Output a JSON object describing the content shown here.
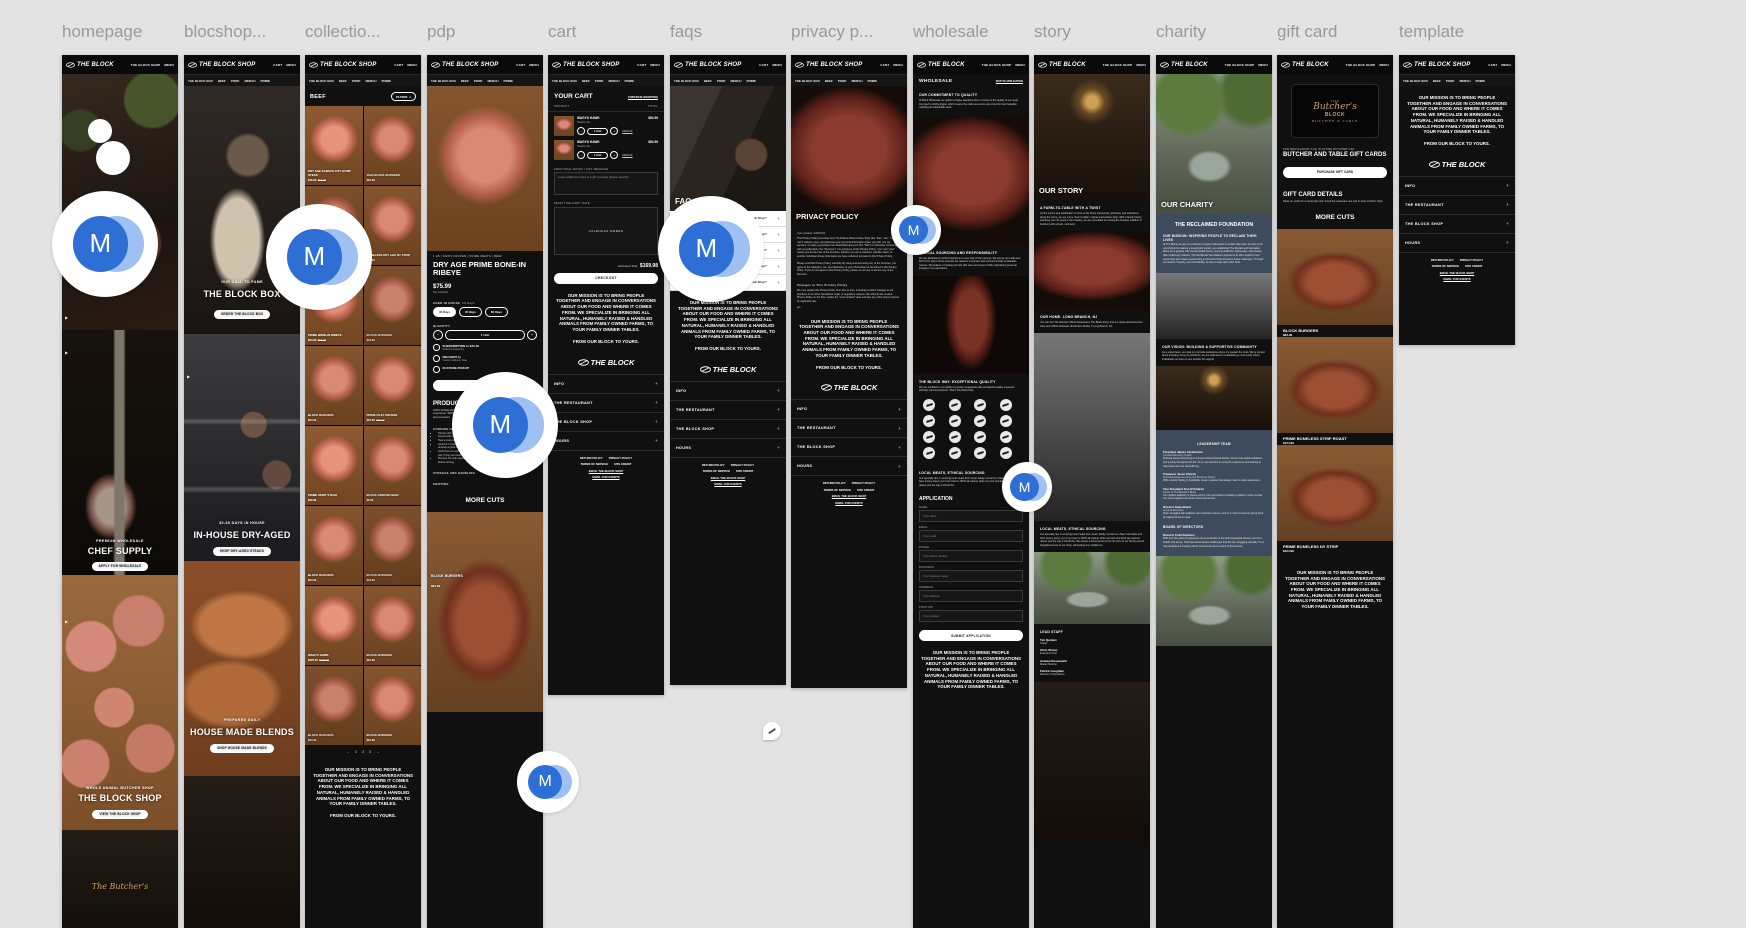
{
  "labels": [
    {
      "text": "homepage",
      "left": "62px"
    },
    {
      "text": "blocshop...",
      "left": "184px"
    },
    {
      "text": "collectio...",
      "left": "305px"
    },
    {
      "text": "pdp",
      "left": "427px"
    },
    {
      "text": "cart",
      "left": "548px"
    },
    {
      "text": "faqs",
      "left": "670px"
    },
    {
      "text": "privacy p...",
      "left": "791px"
    },
    {
      "text": "wholesale",
      "left": "913px"
    },
    {
      "text": "story",
      "left": "1034px"
    },
    {
      "text": "charity",
      "left": "1156px"
    },
    {
      "text": "gift card",
      "left": "1277px"
    },
    {
      "text": "template",
      "left": "1399px"
    }
  ],
  "chrome": {
    "logo_block": "THE BLOCK",
    "logo_shop": "THE BLOCK SHOP",
    "right_shop": [
      "CART",
      "MENU"
    ],
    "right_block": [
      "THE BLOCK SHOP",
      "MENU"
    ],
    "nav": [
      "THE BLOCK BOX",
      "BEEF",
      "PORK",
      "MERCH",
      "PRIME"
    ],
    "play": "▶"
  },
  "mission": {
    "text": "OUR MISSION IS TO BRING PEOPLE TOGETHER AND ENGAGE IN CONVERSATIONS ABOUT OUR FOOD AND WHERE IT COMES FROM. WE SPECIALIZE IN BRINGING ALL NATURAL, HUMANELY RAISED & HANDLED ANIMALS FROM FAMILY OWNED FARMS, TO YOUR FAMILY DINNER TABLES.",
    "tagline": "FROM OUR BLOCK TO YOURS."
  },
  "footer": {
    "accordion": [
      "INFO",
      "THE RESTAURANT",
      "THE BLOCK SHOP",
      "HOURS"
    ],
    "plus": "+",
    "links_row1": [
      "RETURN POLICY",
      "PRIVACY POLICY"
    ],
    "links_row2": [
      "TERMS OF SERVICE",
      "SITE CREDIT"
    ],
    "email1": "EMAIL THE BLOCK SHOP",
    "email2": "EMAIL FOR EVENTS"
  },
  "homepage": {
    "sign": "OCK",
    "neon": "The Butcher's",
    "hero2": {
      "k": "PREMIUM WHOLESALE",
      "t": "CHEF SUPPLY",
      "b": "APPLY FOR WHOLESALE"
    },
    "hero3": {
      "k": "WHOLE ANIMAL BUTCHER SHOP",
      "t": "THE BLOCK SHOP",
      "b": "VIEW THE BLOCK SHOP"
    }
  },
  "blockshop": {
    "hero1": {
      "k": "OUR CALL TO FAME",
      "t": "THE BLOCK BOX",
      "b": "ORDER THE BLOCK BOX"
    },
    "hero2": {
      "k": "30-60 DAYS IN HOUSE",
      "t": "IN-HOUSE DRY-AGED",
      "b": "SHOP DRY-AGED STEAKS"
    },
    "hero3": {
      "k": "PREPARED DAILY",
      "t": "HOUSE MADE BLENDS",
      "b": "SHOP HOUSE MADE BLENDS"
    }
  },
  "collection": {
    "title": "BEEF",
    "filters": "FILTERS",
    "filters_icon": "≡",
    "products": [
      {
        "n": "DRY AGE KANSAS CITY STRIP STEAK",
        "p": "$46.99",
        "o": "$64.99"
      },
      {
        "n": "10LB BLOCK BURGERS",
        "p": "$84.99"
      },
      {
        "n": "BLOCK BURGERS",
        "p": "$64.99"
      },
      {
        "n": "BONELESS DRY AGE NY STRIP",
        "p": "$52.99"
      },
      {
        "n": "PRIME BONE-IN RIBEYE",
        "p": "$24.99",
        "o": "$69.99"
      },
      {
        "n": "BLOCK BURGERS",
        "p": "$64.99"
      },
      {
        "n": "BLOCK BURGERS",
        "p": "$64.99"
      },
      {
        "n": "PRIME FILET MIGNON",
        "p": "$52.99",
        "o": "$64.99"
      },
      {
        "n": "PRIME SKIRT STEAK",
        "p": "$29.99"
      },
      {
        "n": "BLOCK GROUND BEEF",
        "p": "$6.99"
      },
      {
        "n": "BLOCK BURGERS",
        "p": "$64.99"
      },
      {
        "n": "BLOCK BURGERS",
        "p": "$64.99"
      },
      {
        "n": "WAGYU HAWK",
        "p": "$225.00",
        "o": "$275.00"
      },
      {
        "n": "BLOCK BURGERS",
        "p": "$64.99"
      },
      {
        "n": "BLOCK BURGERS",
        "p": "$64.99"
      },
      {
        "n": "BLOCK BURGERS",
        "p": "$64.99"
      }
    ],
    "pagination": [
      "←",
      "1",
      "2",
      "3",
      "→"
    ]
  },
  "pdp": {
    "meta": "1 LB  |  SHIPS FROZEN  |  PRIME MEATS  |  BEEF",
    "title": "DRY AGE PRIME BONE-IN RIBEYE",
    "price": "$75.99",
    "tax": "Tax included.",
    "aged_label": "AGED IN HOUSE",
    "aged_value": "30 Days",
    "pills": [
      "30 Days",
      "45 Days",
      "60 Days"
    ],
    "qty_label": "QUANTITY",
    "qty": "1 Unit",
    "minus": "−",
    "plus": "+",
    "options": [
      {
        "t": "SUBSCRIPTION to $72.19",
        "s": "Delivery frequency"
      },
      {
        "t": "DELIVERY to",
        "s": "Custom delivery date"
      },
      {
        "t": "IN-STORE PICKUP",
        "s": ""
      }
    ],
    "add_label": "",
    "details_h": "PRODUCT DETAILS",
    "details": "100% All Natural Prime Beef. Aged in house for either 30, 45, or 60 days for a savory experience. While the ribeye is relatively lean, the meat surrounding the bone is fatty and succulent.",
    "cooking_h": "COOKING INSTRUCTIONS",
    "bullets": [
      "Pat the strip steaks dry with paper towels",
      "Generously season both sides of the steaks.",
      "Heat a cast-iron skillet over high heat for 5 to 6 minutes.",
      "Cook for 2 minutes on each side, pressing the strip steaks down gently to help them develop a good sear.",
      "Cook them on each side again for 1 minute. If they are at 110°F, remove them from the pan. If they are below that temperature, continue cooking them for 1 minute on each.",
      "Remove the strip steaks from the pan and set them aside to rest for 5 to 10 minutes before serving."
    ],
    "storage_h": "STORAGE AND HANDLING",
    "shipping_h": "SHIPPING",
    "more_cuts": "MORE CUTS",
    "more_product": {
      "n": "BLOCK BURGERS",
      "p": "$84.99"
    }
  },
  "cart": {
    "title": "YOUR CART",
    "continue": "CONTINUE SHOPPING",
    "col_product": "PRODUCT",
    "col_total": "TOTAL",
    "items": [
      {
        "n": "WAGYU HAWK",
        "price": "$84.99",
        "variant": "Variant info",
        "qty": "1 Unit",
        "remove": "REMOVE"
      },
      {
        "n": "WAGYU HAWK",
        "price": "$84.99",
        "variant": "Variant info",
        "qty": "1 Unit",
        "remove": "REMOVE"
      }
    ],
    "notes_label": "ADDITIONAL NOTES / GIFT MESSAGE",
    "notes_placeholder": "Leave additional notes or a gift message (please specify)",
    "date_label": "SELECT DELIVERY DATE",
    "calendar": "CALENDAR EMBED",
    "total_label": "Estimated Total:",
    "total": "$169.98",
    "checkout": "CHECKOUT"
  },
  "faqs": {
    "title": "FAQs",
    "rows": [
      {
        "q": "What is a common question you are asked about the Block Shop?"
      },
      {
        "q": "What is a common question you are asked about the Block Shop?"
      },
      {
        "q": "What is a common question you are asked about the Block Shop?"
      },
      {
        "q": "What is a common question you are asked about the Block Shop?"
      },
      {
        "q": "What is a common question you are asked about the Block Shop?"
      }
    ],
    "plus": "+"
  },
  "privacy": {
    "title": "PRIVACY POLICY",
    "updated": "Last updated: 9/28/2023",
    "p1": "This Privacy Policy describes how The Butcher Block Online Shop (the \"Site\", \"we\", \"us\", or \"our\") collects, uses, and discloses your personal information when you visit, use our services, or make a purchase from theblockshopnj.com (the \"Site\") or otherwise communicate with us (collectively, the \"Services\"). For purposes of this Privacy Policy, \"you\" and \"your\" means you as the user of the Services, whether you are a customer, website visitor, or another individual whose information we have collected pursuant to this Privacy Policy.",
    "p2": "Please read this Privacy Policy carefully. By using and accessing any of the Services, you agree to the collection, use, and disclosure of your information as described in this Privacy Policy. If you do not agree to this Privacy Policy, please do not use or access any of the Services.",
    "changes_h": "Changes to This Privacy Policy",
    "p3": "We may update this Privacy Policy from time to time, including to reflect changes to our practices or for other operational, legal, or regulatory reasons. We will post the revised Privacy Policy on the Site, update the \"Last updated\" date and take any other steps required by applicable law.",
    "etc": "etc..."
  },
  "wholesale": {
    "title": "WHOLESALE",
    "skip": "SKIP TO APPLICATION",
    "s1h": "OUR COMMITMENT TO QUALITY",
    "s1p": "At Block Wholesale we uphold a higher standard when it comes to the quality of our meat. Our beef is strictly Angus, which means the cattle we source are prized for their beautiful marbling and delectable taste.",
    "s2h": "ETHICAL SOURCING AND RESPONSIBILITY",
    "s2p": "We are dedicated to ethical practices in every step of the process. We source our cattle and lamb from farms where animals are raised in a humane and environmentally sustainable manner. We believe in treating animals with care and respect while maintaining personal integrity in our operations.",
    "s3h": "THE BLOCK WAY: EXCEPTIONAL QUALITY",
    "s3p": "We are confident in our ability to provide restaurants with exceptional quality meat and ethically sourced products. That's The Block Way.",
    "logos": [
      "",
      "",
      "",
      "",
      "",
      "",
      "",
      "",
      "",
      "",
      "",
      "",
      "",
      "",
      "",
      ""
    ],
    "s4h": "LOCAL MEATS, ETHICAL SOURCING",
    "s4p": "Our specialty lies in sourcing local meats from small, family-run farms in New York State and New Jersey. Every cut of our beef is 100% all natural, while our pork and lamb are pasture-raised, just the way it should be.",
    "app_h": "APPLICATION",
    "fields": [
      {
        "l": "NAME",
        "ph": "Your name"
      },
      {
        "l": "EMAIL",
        "ph": "Your email"
      },
      {
        "l": "PHONE",
        "ph": "Your phone number"
      },
      {
        "l": "BUSINESS",
        "ph": "Your business name"
      },
      {
        "l": "ADDRESS",
        "ph": "Your address"
      },
      {
        "l": "POSITION",
        "ph": "Your position"
      }
    ],
    "submit": "SUBMIT APPLICATION"
  },
  "story": {
    "title": "OUR STORY",
    "s1h": "A FARM-TO-TABLE WITH A TWIST",
    "s1p": "As the source and distribution to some of the finest restaurants, pizzerias, and institutions along the shore, we are a true \"farm to table\" market and butcher shop. With a family history spanning over 40 years in the industry, we are committed to reviving the timeless tradition of butchery with a fresh, cool twist.",
    "s2h": "OUR HOME: LONG BRANCH, NJ",
    "s2p": "You can find The Butcher's Block Restaurant, The Block Shop, and our whole animal butcher shop and USDA wholesale distribution facility in Long Branch, NJ.",
    "s3h": "LOCAL MEATS, ETHICAL SOURCING",
    "s3p": "Our specialty lies in sourcing local meats from small, family-run farms in New York State and New Jersey. Every cut of our beef is 100% all natural, while our pork and lamb are pasture-raised, just the way it should be. We amass a direct journey from the farm to our family-owned slaughterhouses to our shop, eliminating any middlemen.",
    "staff_h": "LEAD STAFF",
    "staff": [
      {
        "n": "Tim Quinlan",
        "r": "Owner"
      },
      {
        "n": "Chris Strano",
        "r": "Executive Chef"
      },
      {
        "n": "Andrew Rosenwald",
        "r": "Master Butcher"
      },
      {
        "n": "Patrick Coughlan",
        "r": "Director of Operations"
      }
    ]
  },
  "charity": {
    "title": "OUR CHARITY",
    "panel_h": "THE RECLAIMED FOUNDATION",
    "m_h": "OUR MISSION: INSPIRING PEOPLE TO RECLAIM THEIR LIVES",
    "m_p": "At The Block, we are on a mission to inspire individuals to reclaim their lives. As part of our commitment to making a meaningful impact, we established The Reclaimed Foundation. Many of us grapple with mental health issues, such as addiction, depression, and anxiety, often suffering in silence. The Reclaimed Foundation's purpose is to offer support to our community and create a welcoming environment that embraces these challenges. Through connection, honesty, and vulnerability, we aim to help each other heal.",
    "v_h": "OUR VISION: BUILDING A SUPPORTIVE COMMUNITY",
    "v_p": "As a united team, our goal is to provide assistance where it's needed the most. We're not just about throwing money at problems; we are dedicated to establishing a community where individuals can lean on one another for support.",
    "lead_h": "LEADERSHIP TEAM",
    "leaders": [
      {
        "n": "President James Cardamone",
        "r": "Certified Recovery Coach",
        "b": "Working toward becoming a Licensed Clinical Social Worker, James has tackled addiction and anxiety throughout his life. He is now devoted to using his experience and training to help those who are still suffering."
      },
      {
        "n": "Treasurer Jesse Church",
        "r": "Serial Entrepreneur and Local Business Owner",
        "b": "With a family history in hospitality, Jesse's passion has always been to raise awareness."
      },
      {
        "n": "Vice President Tom D'Ambrisi",
        "r": "Owner of The Butcher's Block",
        "b": "Tom battled addiction in silence and is now committed to building a platform where people can come together and share their experiences."
      },
      {
        "n": "Director Sean Brand",
        "r": "Account Executive",
        "b": "Sean struggled with addiction and substance abuse, and he is now focused on giving back by helping those in need."
      }
    ],
    "board_h": "BOARD OF DIRECTORS",
    "board": [
      {
        "n": "Director Todd Stefanos",
        "b": "With over 20 years of experience as an executive in the pharmaceutical industry and as a health club owner, Todd has faced serious challenges that left him struggling mentally. He is now dedicated to helping others become the best version of themselves."
      }
    ]
  },
  "gift": {
    "card_the": "THE",
    "card_script": "Butcher's",
    "card_block": "BLOCK",
    "card_sub": "BUTCHER & TABLE",
    "kicker": "FOR RESTAURANT AND IN-STORE BUTCHER USE",
    "h": "BUTCHER AND TABLE GIFT CARDS",
    "buy": "PURCHASE GIFT CARD",
    "details_h": "GIFT CARD DETAILS",
    "details": "Place an order for a virtual gift card. Good for restaurant use and in-store butcher shop.",
    "more": "MORE CUTS",
    "products": [
      {
        "n": "BLOCK BURGERS",
        "p": "$84.99"
      },
      {
        "n": "PRIME BONELESS STRIP ROAST",
        "p": "$104.99"
      },
      {
        "n": "PRIME BONELESS NY STRIP",
        "p": "$104.99"
      }
    ]
  },
  "avatars": {
    "letter": "M",
    "list": [
      {
        "left": "52px",
        "top": "191px",
        "size": "106px",
        "av": "58px",
        "fontSize": "26px"
      },
      {
        "left": "266px",
        "top": "204px",
        "size": "106px",
        "av": "58px",
        "fontSize": "26px"
      },
      {
        "left": "452px",
        "top": "372px",
        "size": "106px",
        "av": "58px",
        "fontSize": "26px"
      },
      {
        "left": "658px",
        "top": "196px",
        "size": "106px",
        "av": "58px",
        "fontSize": "26px"
      },
      {
        "left": "891px",
        "top": "205px",
        "size": "50px",
        "av": "30px",
        "fontSize": "14px"
      },
      {
        "left": "1002px",
        "top": "462px",
        "size": "50px",
        "av": "30px",
        "fontSize": "14px"
      },
      {
        "left": "517px",
        "top": "751px",
        "size": "62px",
        "av": "36px",
        "fontSize": "16px"
      }
    ],
    "spots": [
      {
        "left": "88px",
        "top": "119px",
        "size": "24px"
      },
      {
        "left": "96px",
        "top": "141px",
        "size": "34px"
      }
    ],
    "pin": {
      "left": "763px",
      "top": "722px",
      "size": "18px"
    }
  }
}
